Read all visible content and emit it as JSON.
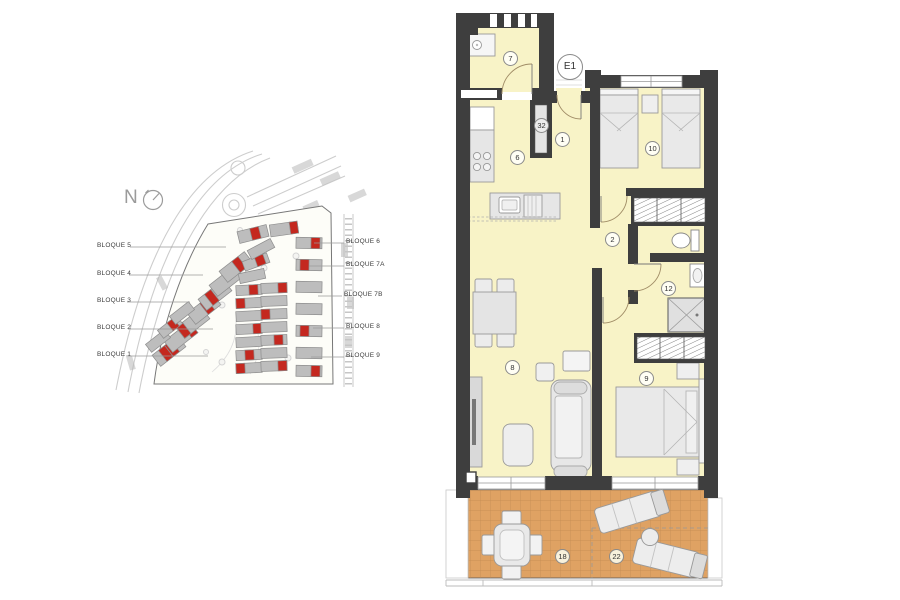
{
  "site_plan": {
    "north_label": "N",
    "left_block_labels": [
      "BLOQUE 5",
      "BLOQUE 4",
      "BLOQUE 3",
      "BLOQUE 2",
      "BLOQUE 1"
    ],
    "right_block_labels": [
      "BLOQUE 6",
      "BLOQUE 7A",
      "BLOQUE 7B",
      "BLOQUE 8",
      "BLOQUE 9"
    ],
    "building_color": "#bdbdbd",
    "highlight_color": "#c4281f"
  },
  "floor_plan": {
    "unit_label": "E1",
    "shaft_label": "32",
    "room_labels": {
      "laundry": "7",
      "hall": "1",
      "kitchen": "6",
      "bedroom_twin": "10",
      "corridor": "2",
      "bathroom": "12",
      "living_room": "8",
      "bedroom_double": "9",
      "terrace": "18",
      "solarium": "22"
    },
    "colors": {
      "wall": "#3e3e3e",
      "floor": "#f8f3c7",
      "terrace_floor": "#dfa263"
    }
  }
}
